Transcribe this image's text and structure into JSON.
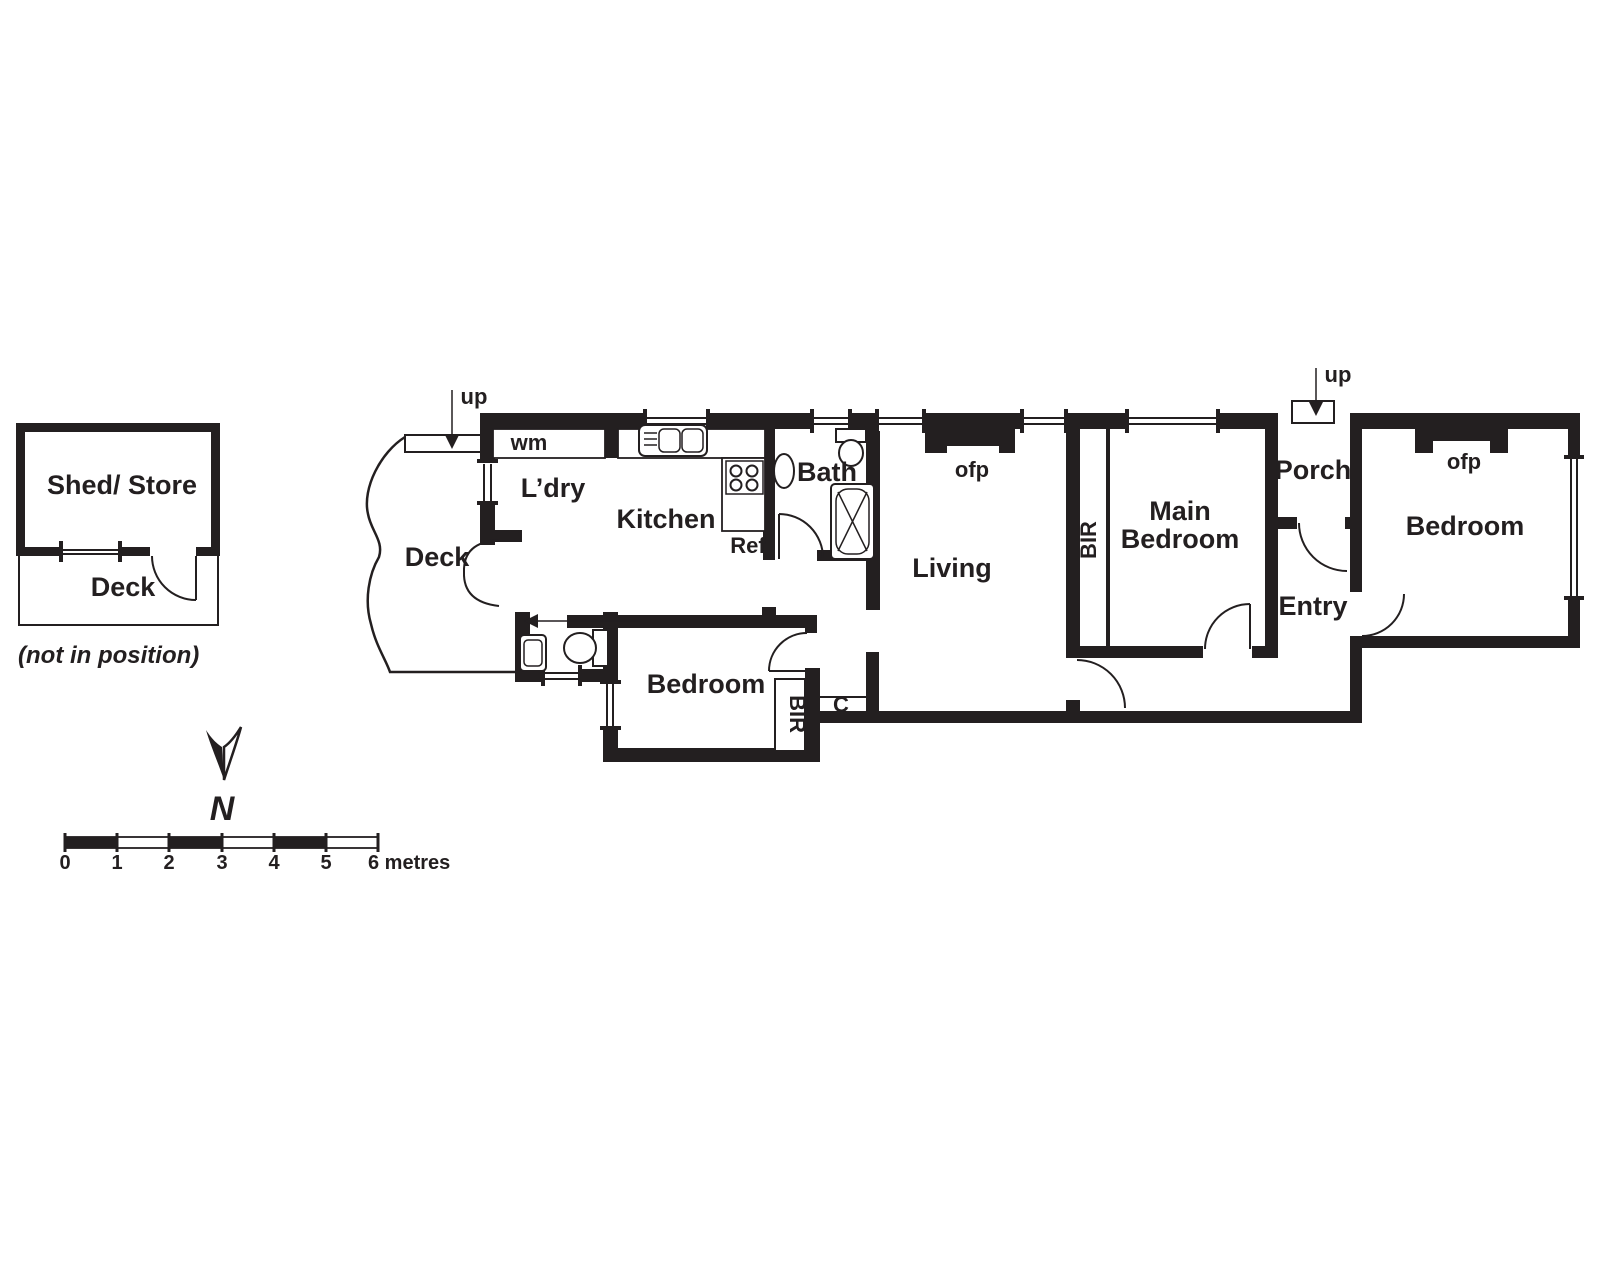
{
  "outbuilding": {
    "shed_label": "Shed/ Store",
    "deck_label": "Deck",
    "note": "(not in position)"
  },
  "compass": {
    "north_label": "N"
  },
  "scale_bar": {
    "tick_labels": [
      "0",
      "1",
      "2",
      "3",
      "4",
      "5"
    ],
    "end_label": "6 metres"
  },
  "rooms": {
    "deck": "Deck",
    "laundry": "L’dry",
    "kitchen": "Kitchen",
    "bath": "Bath",
    "living": "Living",
    "main_bedroom_line1": "Main",
    "main_bedroom_line2": "Bedroom",
    "porch": "Porch",
    "entry": "Entry",
    "bedroom_right": "Bedroom",
    "bedroom_rear": "Bedroom"
  },
  "annotations": {
    "wm": "wm",
    "ref": "Ref",
    "ofp_living": "ofp",
    "ofp_bedroom": "ofp",
    "bir_main": "BIR",
    "bir_rear": "BIR",
    "closet": "C",
    "up_deck": "up",
    "up_porch": "up"
  },
  "colors": {
    "wall": "#231f20",
    "background": "#ffffff"
  }
}
